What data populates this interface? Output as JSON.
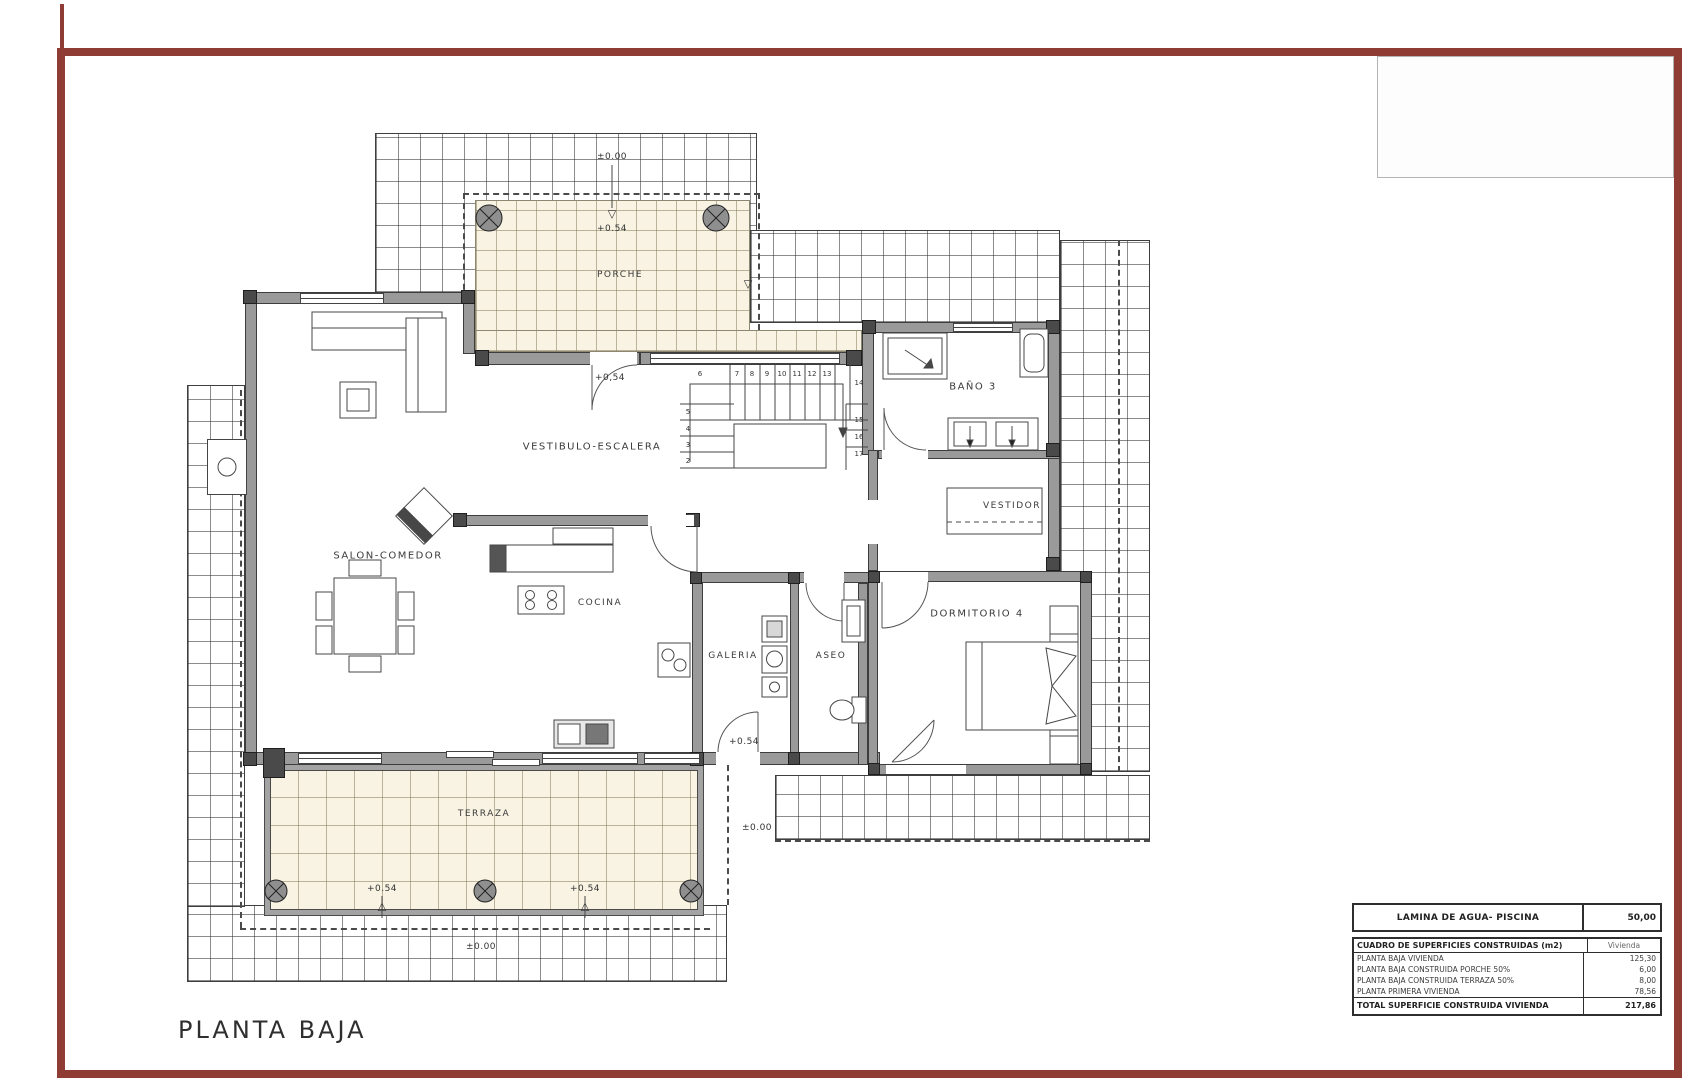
{
  "sheet": {
    "title": "PLANTA BAJA"
  },
  "rooms": {
    "porche": "PORCHE",
    "vestibulo": "VESTIBULO-ESCALERA",
    "bano3": "BAÑO 3",
    "vestidor": "VESTIDOR",
    "salon": "SALON-COMEDOR",
    "cocina": "COCINA",
    "galeria": "GALERIA",
    "aseo": "ASEO",
    "dormitorio4": "DORMITORIO 4",
    "terraza": "TERRAZA"
  },
  "levels": {
    "top": "±0.00",
    "porch": "+0.54",
    "vestibule": "+0,54",
    "galeria": "+0.54",
    "right": "±0.00",
    "terraza_a": "+0.54",
    "terraza_b": "+0.54",
    "bottom": "±0.00"
  },
  "icons": {
    "tri_down": "▽",
    "tri_up": "△"
  },
  "stairs": {
    "steps": [
      "2",
      "3",
      "4",
      "5",
      "6",
      "7",
      "8",
      "9",
      "10",
      "11",
      "12",
      "13",
      "14",
      "15",
      "16",
      "17"
    ]
  },
  "table": {
    "pool": {
      "label": "LAMINA DE AGUA- PISCINA",
      "value": "50,00"
    },
    "header": {
      "label": "CUADRO DE SUPERFICIES CONSTRUIDAS (m2)",
      "value": "Vivienda"
    },
    "rows": [
      {
        "label": "PLANTA BAJA VIVIENDA",
        "value": "125,30"
      },
      {
        "label": "PLANTA BAJA CONSTRUIDA PORCHE 50%",
        "value": "6,00"
      },
      {
        "label": "PLANTA BAJA CONSTRUIDA TERRAZA 50%",
        "value": "8,00"
      },
      {
        "label": "PLANTA PRIMERA VIVIENDA",
        "value": "78,56"
      }
    ],
    "total": {
      "label": "TOTAL SUPERFICIE CONSTRUIDA VIVIENDA",
      "value": "217,86"
    }
  },
  "colors": {
    "frame": "#8f3c34",
    "tile": "#f8f3e2",
    "wall": "#9a9a9a"
  }
}
